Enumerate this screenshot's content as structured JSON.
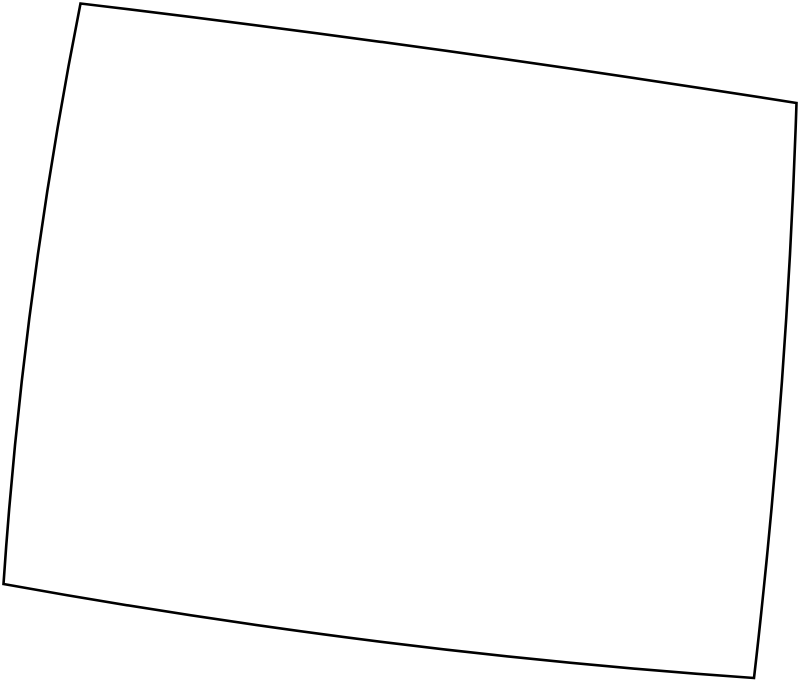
{
  "page": {
    "width_px": 800,
    "height_px": 683,
    "background_color": "#ffffff"
  },
  "map": {
    "type": "outline-map",
    "description": "Blank black-and-white outline of a four-sided state/region boundary (slightly tilted quadrilateral with gently outward-bowed edges), no labels or text",
    "viewbox": "0 0 800 683",
    "outline": {
      "path": "M 80.5 3.5 Q 438.5 46.3 796.5 103 Q 787.3 390.5 754 678 Q 378.8 652 3.5 584 Q 23 293.8 80.5 3.5 Z",
      "stroke_color": "#000000",
      "stroke_width": "2.6",
      "fill_color": "#ffffff",
      "linejoin": "miter",
      "corners": {
        "top_left": [
          80.5,
          3.5
        ],
        "top_right": [
          796.5,
          103
        ],
        "bottom_right": [
          754,
          678
        ],
        "bottom_left": [
          3.5,
          584
        ]
      },
      "edge_bulge_px": {
        "top": 3.5,
        "right": 6,
        "bottom": 10.5,
        "left": 9.5
      }
    }
  }
}
